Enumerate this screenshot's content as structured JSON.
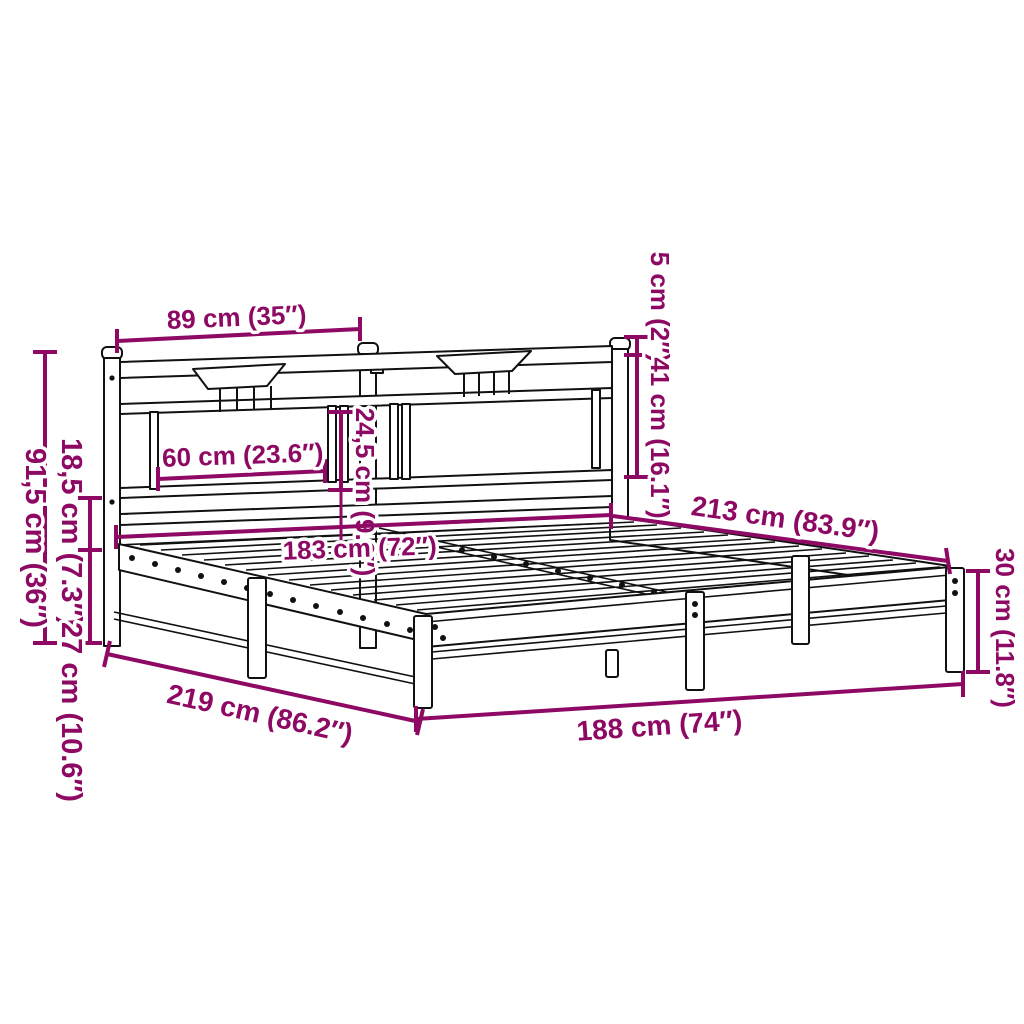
{
  "meta": {
    "type": "product-dimension-diagram",
    "subject": "metal bed frame with headboard",
    "background_color": "#ffffff",
    "line_art_color": "#111111",
    "dimension_color": "#8d0963"
  },
  "dimensions": {
    "headboard_section_width": {
      "label": "89 cm (35″)"
    },
    "post_cap_height": {
      "label": "5 cm (2″)"
    },
    "headboard_top_to_rail": {
      "label": "41 cm (16.1″)"
    },
    "panel_height": {
      "label": "24,5 cm (9.6″)"
    },
    "panel_width": {
      "label": "60 cm (23.6″)"
    },
    "headboard_height": {
      "label": "91,5 cm (36″)"
    },
    "rail_to_frame_height": {
      "label": "18,5 cm (7.3″)"
    },
    "frame_to_floor_height": {
      "label": "27 cm (10.6″)"
    },
    "inner_length": {
      "label": "213 cm (83.9″)"
    },
    "inner_width": {
      "label": "183 cm (72″)"
    },
    "frame_side_height": {
      "label": "30 cm (11.8″)"
    },
    "outer_length": {
      "label": "219 cm (86.2″)"
    },
    "outer_width": {
      "label": "188 cm (74″)"
    }
  }
}
